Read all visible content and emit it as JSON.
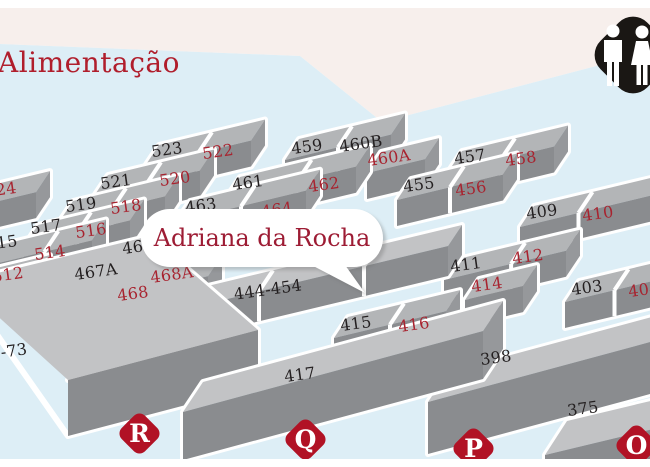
{
  "area": {
    "label": "Alimentação"
  },
  "tooltip": {
    "exhibitor": "Adriana da Rocha"
  },
  "legend": {
    "restroom_icon": "restroom-icon"
  },
  "colors": {
    "booth_red": "#a8232f",
    "booth_black": "#231f20",
    "marker_red": "#b11225",
    "map_blue": "#ddeef6",
    "top_area_beige": "#f7efec",
    "block_top": "#b3b5b7",
    "block_front": "#8a8c8f",
    "callout_text": "#9d1c34"
  },
  "booths": [
    {
      "number": "523",
      "color": "black"
    },
    {
      "number": "522",
      "color": "red"
    },
    {
      "number": "521",
      "color": "black"
    },
    {
      "number": "520",
      "color": "red"
    },
    {
      "number": "519",
      "color": "black"
    },
    {
      "number": "518",
      "color": "red"
    },
    {
      "number": "517",
      "color": "black"
    },
    {
      "number": "516",
      "color": "red"
    },
    {
      "number": "515",
      "color": "black"
    },
    {
      "number": "514",
      "color": "red"
    },
    {
      "number": "524",
      "color": "red"
    },
    {
      "number": "512",
      "color": "red"
    },
    {
      "number": "459",
      "color": "black"
    },
    {
      "number": "460B",
      "color": "black"
    },
    {
      "number": "460A",
      "color": "red"
    },
    {
      "number": "461",
      "color": "black"
    },
    {
      "number": "462",
      "color": "red"
    },
    {
      "number": "463",
      "color": "black"
    },
    {
      "number": "464",
      "color": "red"
    },
    {
      "number": "457",
      "color": "black"
    },
    {
      "number": "458",
      "color": "red"
    },
    {
      "number": "455",
      "color": "black"
    },
    {
      "number": "456",
      "color": "red"
    },
    {
      "number": "409",
      "color": "black"
    },
    {
      "number": "410",
      "color": "red"
    },
    {
      "number": "411",
      "color": "black"
    },
    {
      "number": "412",
      "color": "red"
    },
    {
      "number": "414",
      "color": "red"
    },
    {
      "number": "403",
      "color": "black"
    },
    {
      "number": "404",
      "color": "red"
    },
    {
      "number": "467",
      "color": "black"
    },
    {
      "number": "467A",
      "color": "black"
    },
    {
      "number": "468A",
      "color": "red"
    },
    {
      "number": "468",
      "color": "red"
    },
    {
      "number": "444-454",
      "color": "black"
    },
    {
      "number": "415",
      "color": "black"
    },
    {
      "number": "416",
      "color": "red"
    },
    {
      "number": "417",
      "color": "black"
    },
    {
      "number": "398",
      "color": "black"
    },
    {
      "number": "375",
      "color": "black"
    },
    {
      "number": "-73",
      "color": "black"
    }
  ],
  "markers": [
    {
      "letter": "S"
    },
    {
      "letter": "R"
    },
    {
      "letter": "Q"
    },
    {
      "letter": "P"
    },
    {
      "letter": "O"
    }
  ]
}
